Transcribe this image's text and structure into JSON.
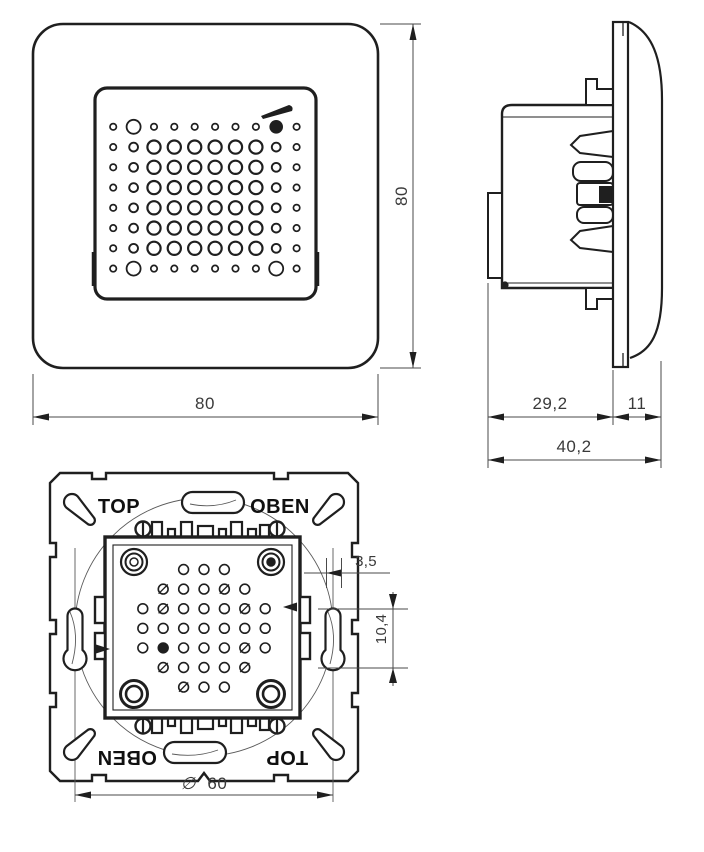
{
  "drawing": {
    "type": "technical-dimension-drawing",
    "views": {
      "front": {
        "dim_width": "80",
        "dim_height": "80"
      },
      "side": {
        "dim_body_depth": "29,2",
        "dim_frame_depth": "11",
        "dim_total_depth": "40,2"
      },
      "rear": {
        "label_top_left": "TOP",
        "label_top_right": "OBEN",
        "label_bottom_left": "OBEN",
        "label_bottom_right": "TOP",
        "dim_slot_width": "3,5",
        "dim_slot_length": "10,4",
        "dim_diameter_symbol": "∅",
        "dim_diameter_value": "60"
      }
    }
  },
  "figures": {
    "front_grille": {
      "col_start": 113.2,
      "col_step": 20.38,
      "row_start": 126.8,
      "row_step": 20.25,
      "sizes": {
        "s": {
          "r": 3.2,
          "sw": 1.7
        },
        "m": {
          "r": 4.4,
          "sw": 1.9
        },
        "L": {
          "r": 6.6,
          "sw": 2.2
        },
        "x": {
          "r": 7.0,
          "sw": 1.8
        },
        "f": {
          "r": 6.8,
          "sw": 0,
          "fill": true
        }
      },
      "pattern": [
        [
          "s",
          "x",
          "s",
          "s",
          "s",
          "s",
          "s",
          "s",
          "f",
          "s"
        ],
        [
          "s",
          "m",
          "L",
          "L",
          "L",
          "L",
          "L",
          "L",
          "m",
          "s"
        ],
        [
          "s",
          "m",
          "L",
          "L",
          "L",
          "L",
          "L",
          "L",
          "m",
          "s"
        ],
        [
          "s",
          "m",
          "L",
          "L",
          "L",
          "L",
          "L",
          "L",
          "m",
          "s"
        ],
        [
          "s",
          "m",
          "L",
          "L",
          "L",
          "L",
          "L",
          "L",
          "m",
          "s"
        ],
        [
          "s",
          "m",
          "L",
          "L",
          "L",
          "L",
          "L",
          "L",
          "m",
          "s"
        ],
        [
          "s",
          "m",
          "L",
          "L",
          "L",
          "L",
          "L",
          "L",
          "m",
          "s"
        ],
        [
          "s",
          "x",
          "s",
          "s",
          "s",
          "s",
          "s",
          "s",
          "x",
          "s"
        ]
      ]
    },
    "rear_grid": {
      "center_x": 204,
      "row_start": 569.5,
      "row_step": 19.6,
      "col_step": 20.4,
      "hole_r": 4.9,
      "hole_sw": 1.6,
      "row_counts": [
        3,
        5,
        7,
        7,
        7,
        5,
        3
      ],
      "slashed": [
        [
          1,
          0
        ],
        [
          1,
          3
        ],
        [
          2,
          1
        ],
        [
          2,
          5
        ],
        [
          4,
          5
        ],
        [
          5,
          0
        ],
        [
          5,
          4
        ],
        [
          6,
          0
        ]
      ],
      "filled": [
        [
          4,
          1
        ]
      ]
    }
  },
  "colors": {
    "ink": "#1f1f1f",
    "dim_text": "#3a3a3a",
    "background": "#ffffff"
  }
}
